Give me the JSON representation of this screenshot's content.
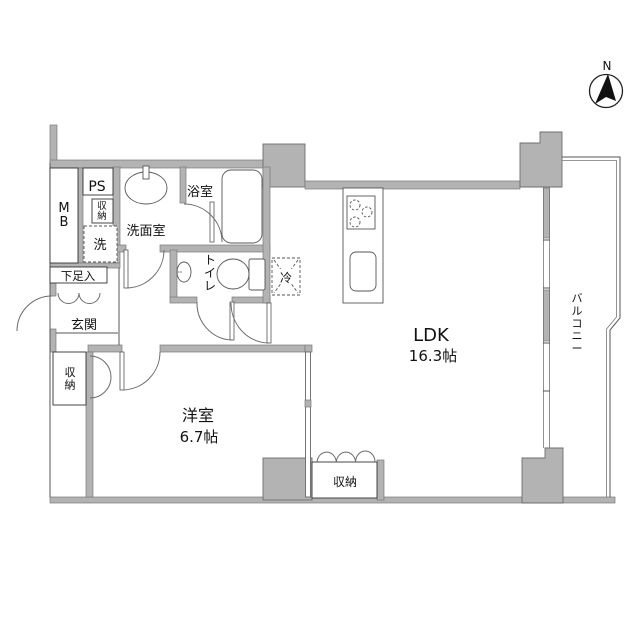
{
  "plan": {
    "compass_label": "N",
    "rooms": {
      "ldk": {
        "name": "LDK",
        "size": "16.3帖"
      },
      "western_room": {
        "name": "洋室",
        "size": "6.7帖"
      },
      "balcony": {
        "name": "バルコニー"
      },
      "entrance": {
        "name": "玄関"
      },
      "washroom": {
        "name": "洗面室"
      },
      "bathroom": {
        "name": "浴室"
      },
      "toilet": {
        "name": "トイレ"
      }
    },
    "labels": {
      "meter_box": "MB",
      "pipe_space": "PS",
      "hall_storage": "収納",
      "washer": "洗",
      "shoe_cabinet": "下足入",
      "fridge": "冷",
      "bedroom_closet": "収納",
      "ldk_closet": "収納"
    }
  }
}
